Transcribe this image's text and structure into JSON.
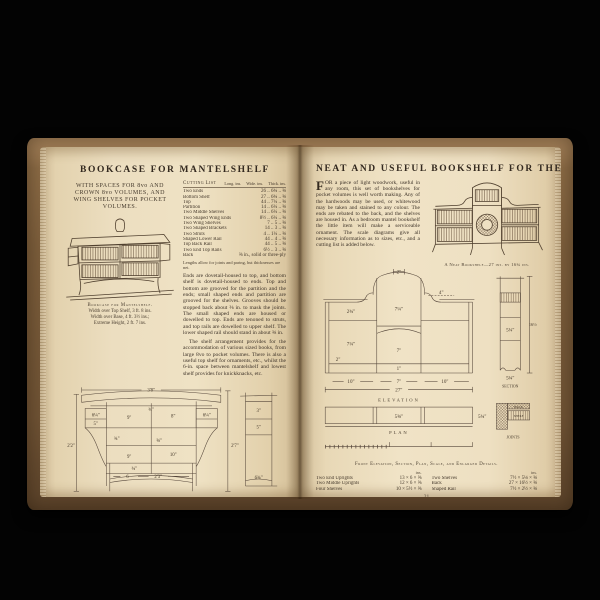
{
  "scene": {
    "background": "#030303",
    "cover_color": "#7c5e3c",
    "page_color": "#eee0c2",
    "ink_color": "#463a2c"
  },
  "left_page": {
    "title": "BOOKCASE FOR MANTELSHELF",
    "subtitle": "WITH SPACES FOR 8vo AND CROWN 8vo VOLUMES, AND WING SHELVES FOR POCKET VOLUMES.",
    "illustration_caption": {
      "title": "Bookcase for Mantelshelf.",
      "line1": "Width over Top Shelf, 3 ft. 8 ins.",
      "line2": "Width over Base, 4 ft. 3½ ins.;",
      "line3": "Extreme Height, 2 ft. 7 ins."
    },
    "cutting_list": {
      "title": "Cutting List",
      "unit_headers": [
        "Long. ins.",
        "Wide. ins.",
        "Thick. ins."
      ],
      "rows": [
        {
          "name": "Two Ends",
          "dims": "26 .. 6¾ .. ⅝"
        },
        {
          "name": "Bottom Shelf",
          "dims": "27 .. 6¾ .. ⅝"
        },
        {
          "name": "Top",
          "dims": "44 .. 7¼ .. ⅝"
        },
        {
          "name": "Partition",
          "dims": "14 .. 6¼ .. ⅝"
        },
        {
          "name": "Two Middle Shelves",
          "dims": "14 .. 6¼ .. ⅝"
        },
        {
          "name": "Two Shaped Wing Ends",
          "dims": "8½ .. 6¼ .. ⅝"
        },
        {
          "name": "Two Wing Shelves",
          "dims": "7 .. 5 .. ⅝"
        },
        {
          "name": "Two Shaped Brackets",
          "dims": "14 .. 3 .. ⅝"
        },
        {
          "name": "Two Struts",
          "dims": "4 .. 1¼ .. ⅝"
        },
        {
          "name": "Shaped Lower Rail",
          "dims": "44 .. 4 .. ⅝"
        },
        {
          "name": "Top Back Rail",
          "dims": "44 .. 5 .. ⅝"
        },
        {
          "name": "Two End Top Rails",
          "dims": "6½ .. 3 .. ⅝"
        },
        {
          "name": "Back",
          "dims": "⅜ in., solid or three-ply"
        }
      ],
      "note": "Lengths allow for joints and paring, but thicknesses are net."
    },
    "paragraphs": [
      "Ends are dovetail-housed to top, and bottom shelf is dovetail-housed to ends. Top and bottom are grooved for the partition and the ends; small shaped ends and partition are grooved for the shelves. Grooves should be stopped back about ⅜ in. to mask the joints. The small shaped ends are housed or dowelled to top. Ends are tenoned to struts, and top rails are dowelled to upper shelf. The lower shaped rail should stand in about ⅜ in.",
      "The shelf arrangement provides for the accommodation of various sized books, from large 8vo to pocket volumes. There is also a useful top shelf for ornaments, etc., whilst the 6-in. space between mantelshelf and lowest shelf provides for knickknacks, etc."
    ],
    "diagram": {
      "caption": "Front Elevation, with Principal Sizes and Scale.",
      "end_view_label": "End View.",
      "dims": {
        "w_top": "3'8\"",
        "t34_top": "¾\"",
        "wing_l": "6¼\"",
        "wing_l2": "5\"",
        "c9_top": "9\"",
        "c8": "8\"",
        "wing_r": "6¼\"",
        "t34_mid": "¾\"",
        "t58": "⅝\"",
        "c9_low": "9\"",
        "c10": "10\"",
        "t34_low": "¾\"",
        "b6": "6",
        "w_bottom": "2'3\"",
        "h_left": "2'2\"",
        "h_right": "2'7\"",
        "ev_3": "3\"",
        "ev_5": "5\"",
        "ev_634": "6¾\""
      },
      "scale_ticks": [
        "1",
        "2",
        "3",
        "4"
      ]
    },
    "page_number": "20"
  },
  "right_page": {
    "title": "NEAT AND USEFUL BOOKSHELF FOR THE BEDROOM",
    "drop_cap": "F",
    "paragraph": "OR a piece of light woodwork, useful in any room, this set of bookshelves for pocket volumes is well worth making. Any of the hardwoods may be used, or whitewood may be taken and stained to any colour. The ends are rebated to the back, and the shelves are housed in. As a bedroom mantel bookshelf the little item will make a serviceable ornament. The scale diagrams give all necessary information as to sizes, etc., and a cutting list is added below.",
    "illustration_caption": "A Neat Bookshelf—27 ins. by 16¾ ins.",
    "diagram": {
      "caption": "Front Elevation, Section, Plan, Scale, and Enlarged Details.",
      "labels": {
        "elevation": "ELEVATION",
        "plan": "PLAN",
        "section": "SECTION",
        "joints": "JOINTS"
      },
      "dims": {
        "top2": "2\"",
        "c714": "7¼\"",
        "s4": "4\"",
        "wl234": "2¾\"",
        "wl714": "7¼\"",
        "c7": "7\"",
        "l2": "2\"",
        "c1": "1\"",
        "b10a": "10\"",
        "b7": "7\"",
        "b10b": "10\"",
        "b27": "27\"",
        "sec_h": "16½\"",
        "sec_in": "5¼\"",
        "sec_b": "5¾\"",
        "plan_c": "5⅝\"",
        "plan_r": "5¾\"",
        "joint_back": "BACK",
        "joint_shelf": "SHELF"
      }
    },
    "cutting_list": {
      "unit_header": "ins.",
      "left": [
        {
          "name": "Two End Uprights",
          "dims": "13 × 6 × ⅝"
        },
        {
          "name": "Two Middle Uprights",
          "dims": "12 × 6 × ⅝"
        },
        {
          "name": "Four Shelves",
          "dims": "10 × 5½ × ⅝"
        }
      ],
      "right": [
        {
          "name": "Two Shelves",
          "dims": "7½ × 5⅛ × ⅝"
        },
        {
          "name": "Back",
          "dims": "27 × 16½ × ⅝"
        },
        {
          "name": "Shaped Rail",
          "dims": "7½ × 2½ × ⅝"
        }
      ]
    },
    "page_number": "21"
  }
}
